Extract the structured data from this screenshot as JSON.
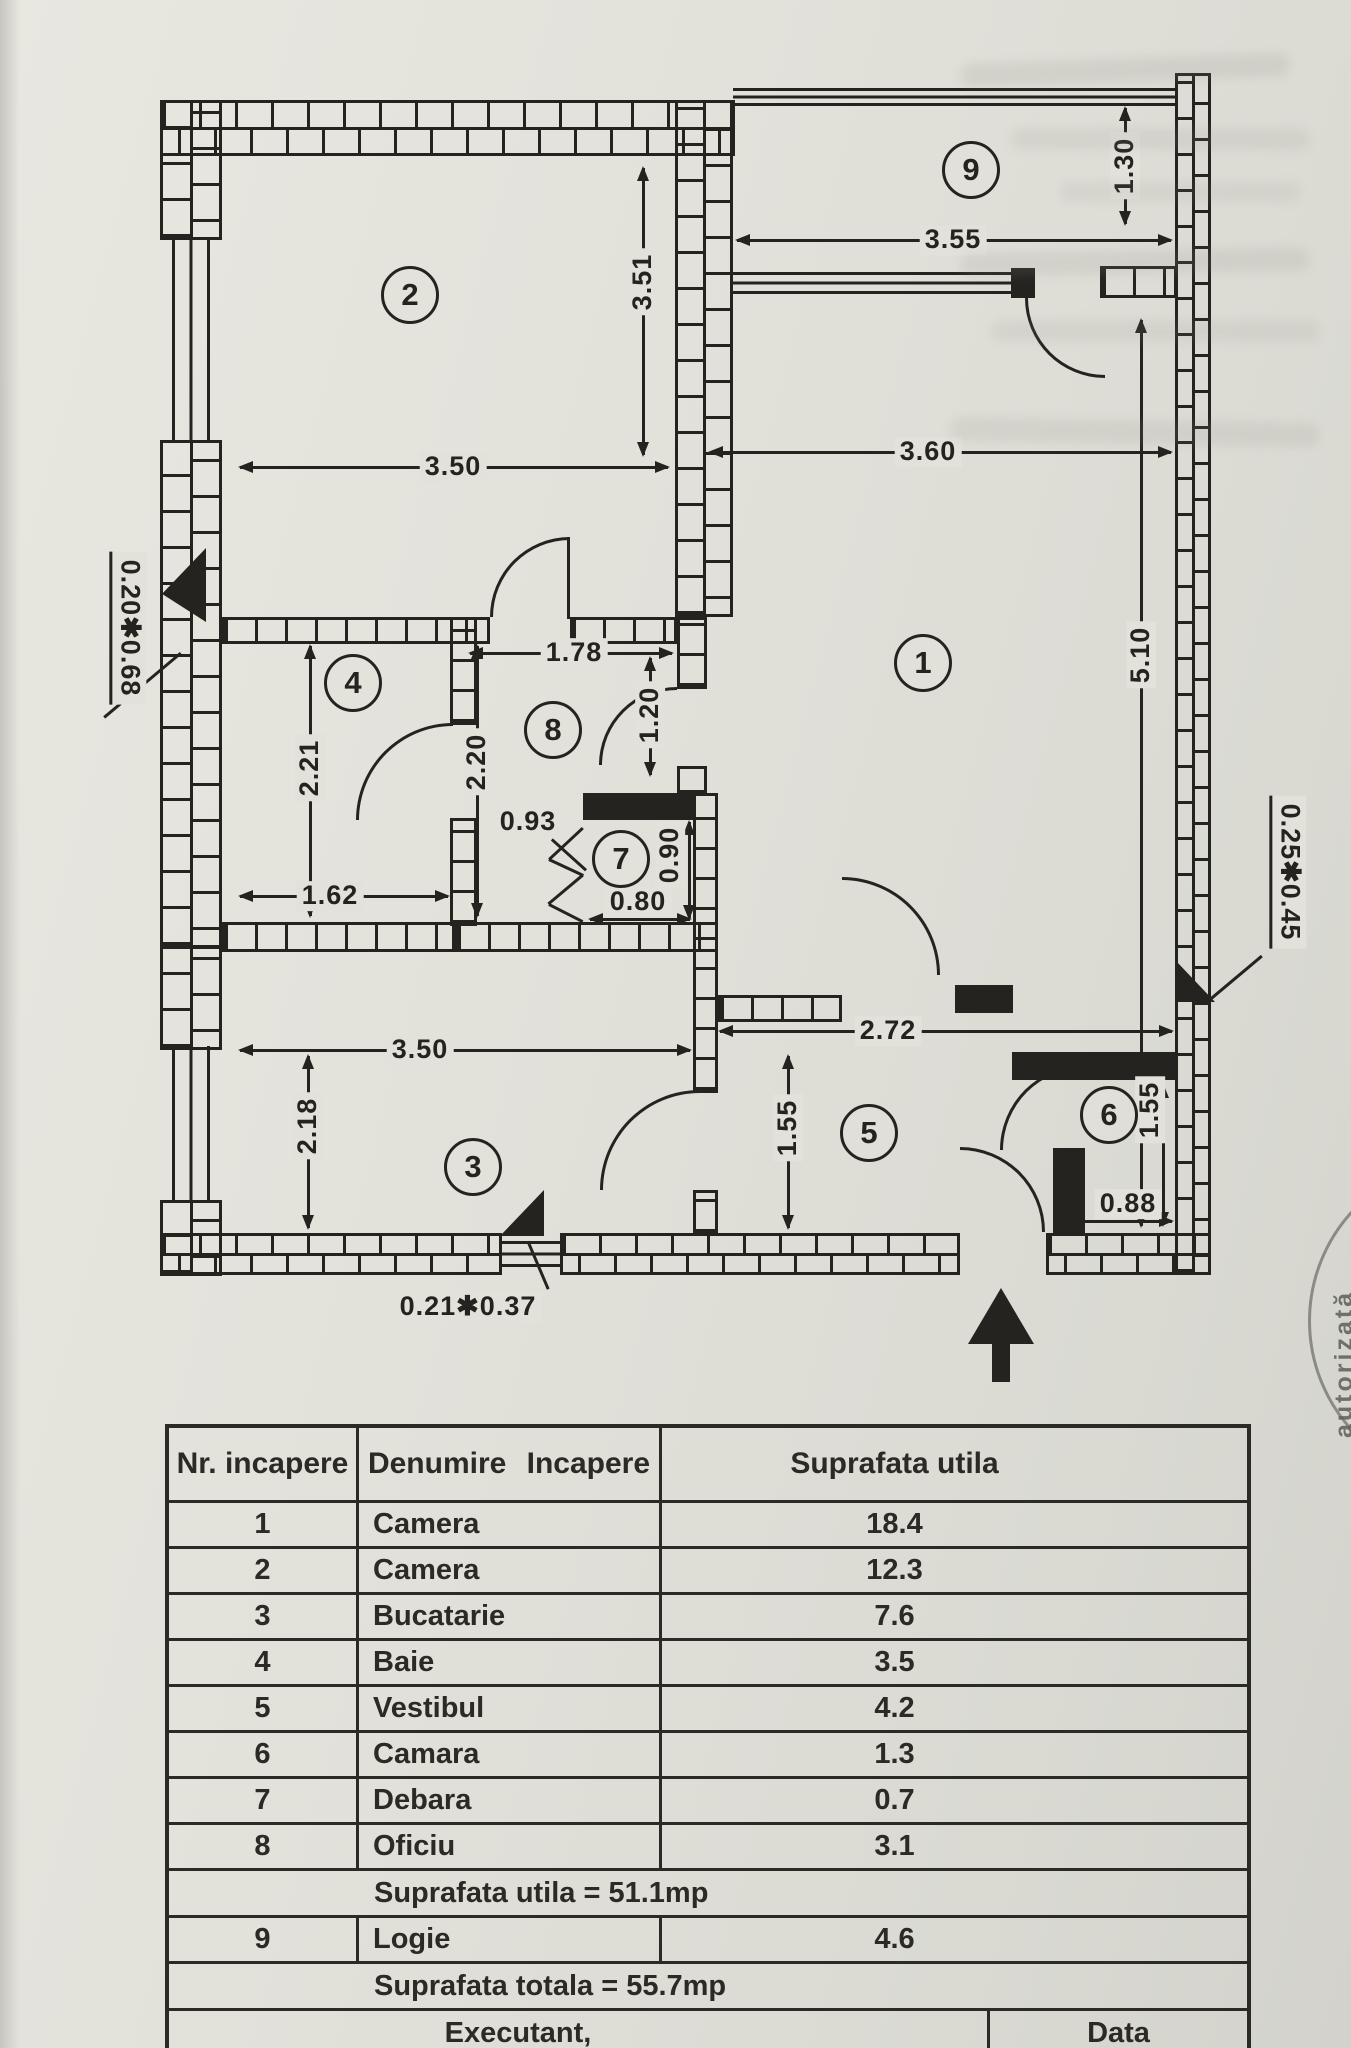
{
  "plan": {
    "rooms": [
      "1",
      "2",
      "3",
      "4",
      "5",
      "6",
      "7",
      "8",
      "9"
    ],
    "dims": [
      "3.50",
      "3.51",
      "3.55",
      "1.30",
      "3.60",
      "5.10",
      "1.78",
      "1.20",
      "2.20",
      "0.93",
      "0.90",
      "0.80",
      "1.62",
      "2.21",
      "3.50",
      "2.18",
      "1.55",
      "2.72",
      "1.55",
      "0.88",
      "0.20✱0.68",
      "0.25✱0.45",
      "0.21✱0.37"
    ]
  },
  "stamp": {
    "text": "autorizată"
  },
  "table": {
    "headers": [
      "Nr. incapere",
      "Denumire Incapere",
      "Suprafata utila"
    ],
    "rows": [
      {
        "nr": "1",
        "name": "Camera",
        "area": "18.4"
      },
      {
        "nr": "2",
        "name": "Camera",
        "area": "12.3"
      },
      {
        "nr": "3",
        "name": "Bucatarie",
        "area": "7.6"
      },
      {
        "nr": "4",
        "name": "Baie",
        "area": "3.5"
      },
      {
        "nr": "5",
        "name": "Vestibul",
        "area": "4.2"
      },
      {
        "nr": "6",
        "name": "Camara",
        "area": "1.3"
      },
      {
        "nr": "7",
        "name": "Debara",
        "area": "0.7"
      },
      {
        "nr": "8",
        "name": "Oficiu",
        "area": "3.1"
      }
    ],
    "subtotal_label": "Suprafata utila = 51.1mp",
    "row9": {
      "nr": "9",
      "name": "Logie",
      "area": "4.6"
    },
    "total_label": "Suprafata totala = 55.7mp",
    "footer": {
      "left": "Executant,",
      "right": "Data"
    }
  }
}
